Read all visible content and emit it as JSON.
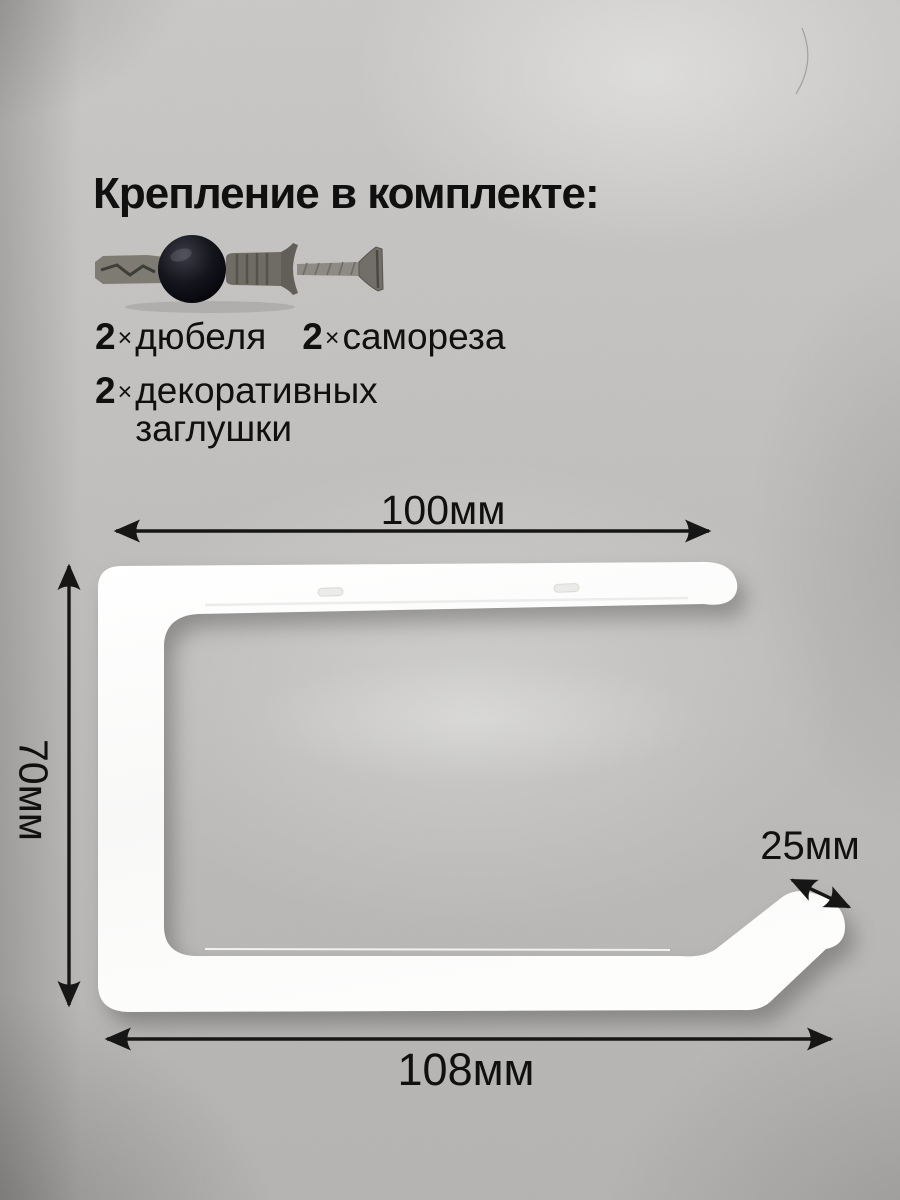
{
  "colors": {
    "text": "#101010",
    "arrow": "#161616",
    "bracket-fill": "#fbfbfa",
    "bracket-shade": "#ececea",
    "background-base": "#c3c2c0"
  },
  "hardware": {
    "title": "Крепление в комплекте:",
    "items_row1": [
      {
        "qty": "2",
        "times": "×",
        "label": "дюбеля"
      },
      {
        "qty": "2",
        "times": "×",
        "label": "самореза"
      }
    ],
    "items_row2": {
      "qty": "2",
      "times": "×",
      "label_line1": "декоративных",
      "label_line2": "заглушки"
    }
  },
  "dimensions": {
    "top_width": "100мм",
    "left_height": "70мм",
    "hook_depth": "25мм",
    "bottom_width": "108мм"
  }
}
